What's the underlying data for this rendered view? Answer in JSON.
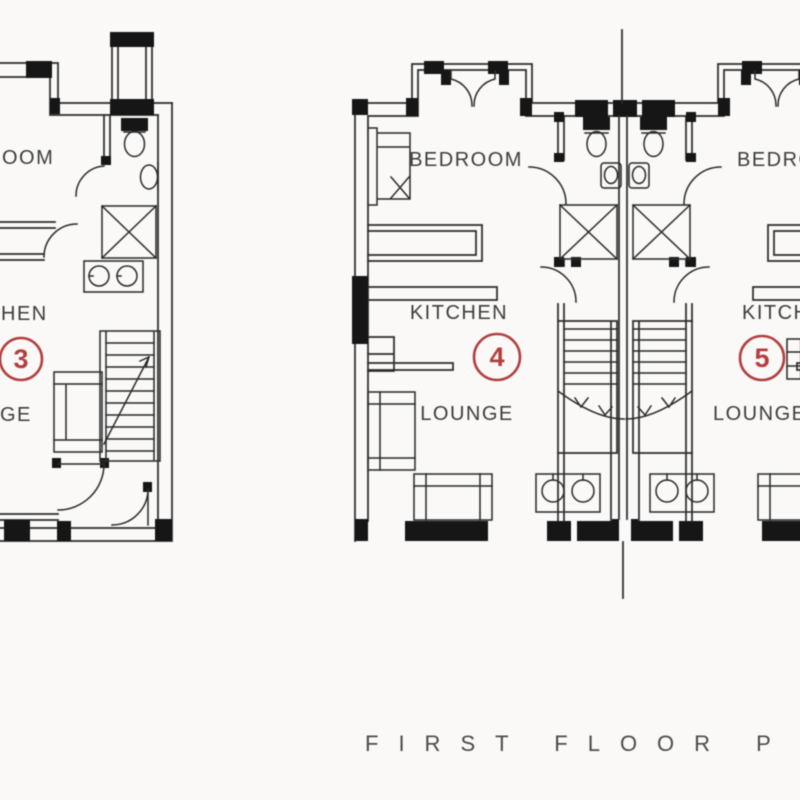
{
  "title": "First floor plan drawing",
  "caption": {
    "text": "FIRST FLOOR P"
  },
  "colors": {
    "background": "#faf9f7",
    "line": "#2b2b2b",
    "solid": "#171717",
    "label": "#3c3c3c",
    "red": "#b2403f",
    "caption": "#4b4b4b"
  },
  "plans": {
    "unit_3": {
      "unit_number": "3",
      "bedroom_label": "OOM",
      "kitchen_label": "HEN",
      "lounge_label": "GE"
    },
    "unit_4": {
      "unit_number": "4",
      "bedroom_label": "BEDROOM",
      "kitchen_label": "KITCHEN",
      "lounge_label": "LOUNGE"
    },
    "unit_5": {
      "unit_number": "5",
      "bedroom_label": "BEDROOM",
      "kitchen_label": "KITCHEN",
      "lounge_label": "LOUNGE"
    }
  }
}
